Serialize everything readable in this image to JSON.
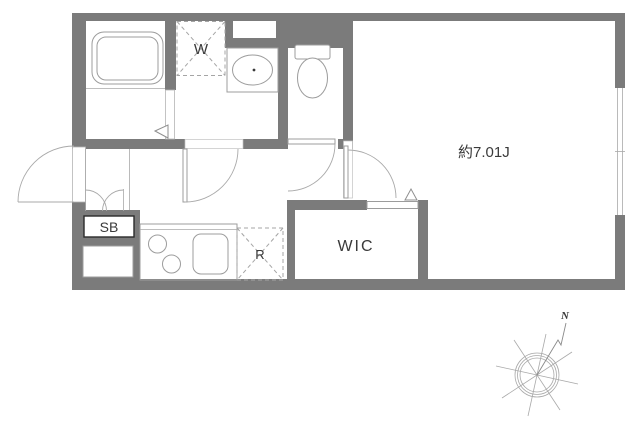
{
  "floor_plan": {
    "labels": {
      "washing_machine": "W",
      "main_room_size": "約7.01J",
      "shoe_box": "SB",
      "refrigerator": "R",
      "walk_in_closet": "WIC",
      "compass_north": "N"
    },
    "colors": {
      "wall": "#7b7b7b",
      "fixture_line": "#9c9c9c",
      "text": "#3a3a3a",
      "background": "#ffffff"
    }
  }
}
